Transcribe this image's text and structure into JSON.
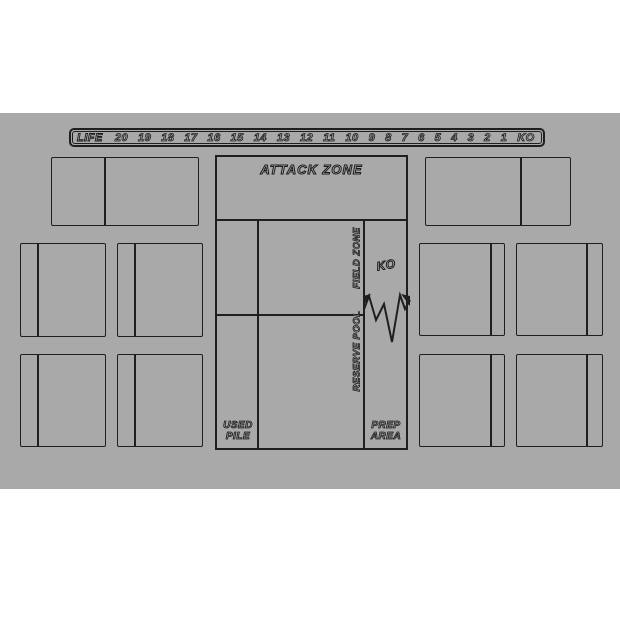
{
  "colors": {
    "page_bg": "#ffffff",
    "mat_bg": "#a9a9a9",
    "line": "#1f1f1f",
    "text_fill": "#b0b0b0",
    "text_outline": "#1c1c1c"
  },
  "life_bar": {
    "label": "LIFE",
    "values": [
      "20",
      "19",
      "18",
      "17",
      "16",
      "15",
      "14",
      "13",
      "12",
      "11",
      "10",
      "9",
      "8",
      "7",
      "6",
      "5",
      "4",
      "3",
      "2",
      "1",
      "KO"
    ]
  },
  "labels": {
    "attack_zone": "ATTACK ZONE",
    "field_zone": "FIELD ZONE",
    "reserve_pool": "RESERVE POOL",
    "ko": "KO",
    "used_pile_line1": "USED",
    "used_pile_line2": "PILE",
    "prep_area_line1": "PREP",
    "prep_area_line2": "AREA"
  }
}
